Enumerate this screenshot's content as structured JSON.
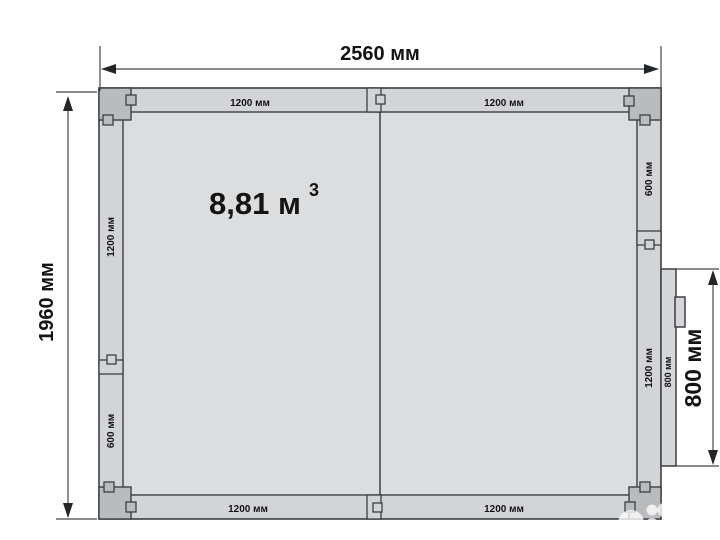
{
  "chamber": {
    "volume": {
      "value": "8,81 м",
      "sup": "3"
    },
    "overall": {
      "width": "2560 мм",
      "height": "1960 мм",
      "door_opening": "800 мм"
    },
    "panels": {
      "top": [
        "1200 мм",
        "1200 мм"
      ],
      "bottom": [
        "1200 мм",
        "1200 мм"
      ],
      "left": [
        "1200 мм",
        "600 мм"
      ],
      "right": [
        "600 мм",
        "1200 мм"
      ],
      "door": "800 мм"
    },
    "colors": {
      "background": "#ffffff",
      "wall_panel": "#d3d4d7",
      "interior": "#dcdddf",
      "corner_piece": "#b9bbbf",
      "outline": "#3c3f43",
      "text": "#141414"
    }
  },
  "watermark": {
    "brand": "Avito"
  }
}
